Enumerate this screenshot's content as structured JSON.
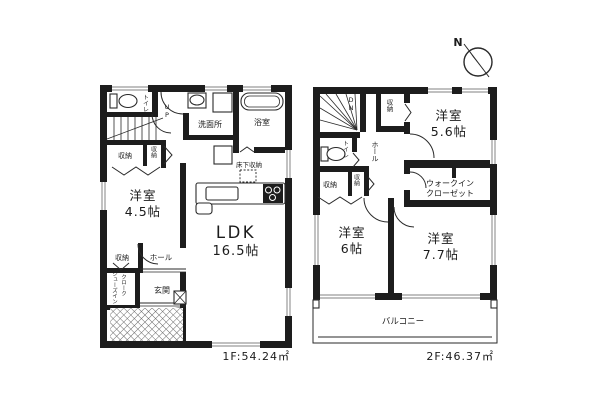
{
  "compass": {
    "north_label": "N"
  },
  "floor1": {
    "area_label": "1F:54.24㎡",
    "rooms": {
      "toilet": "トイレ",
      "stairs": "UP",
      "closet_a": "収納",
      "closet_b": "収納",
      "western_room_name": "洋室",
      "western_room_size": "4.5帖",
      "closet_c": "収納",
      "hall": "ホール",
      "shoes_closet_line1": "シューズイン",
      "shoes_closet_line2": "クローク",
      "entrance": "玄関",
      "washroom": "洗面所",
      "bathroom": "浴室",
      "underfloor_storage": "床下収納",
      "ldk_name": "LDK",
      "ldk_size": "16.5帖"
    }
  },
  "floor2": {
    "area_label": "2F:46.37㎡",
    "rooms": {
      "stairs": "DN",
      "closet_top": "収納",
      "western_room_a_name": "洋室",
      "western_room_a_size": "5.6帖",
      "toilet": "トイレ",
      "hall": "ホール",
      "closet_b": "収納",
      "closet_c": "収納",
      "walk_in_closet_line1": "ウォークイン",
      "walk_in_closet_line2": "クローゼット",
      "western_room_b_name": "洋室",
      "western_room_b_size": "6帖",
      "western_room_c_name": "洋室",
      "western_room_c_size": "7.7帖",
      "balcony": "バルコニー"
    }
  }
}
